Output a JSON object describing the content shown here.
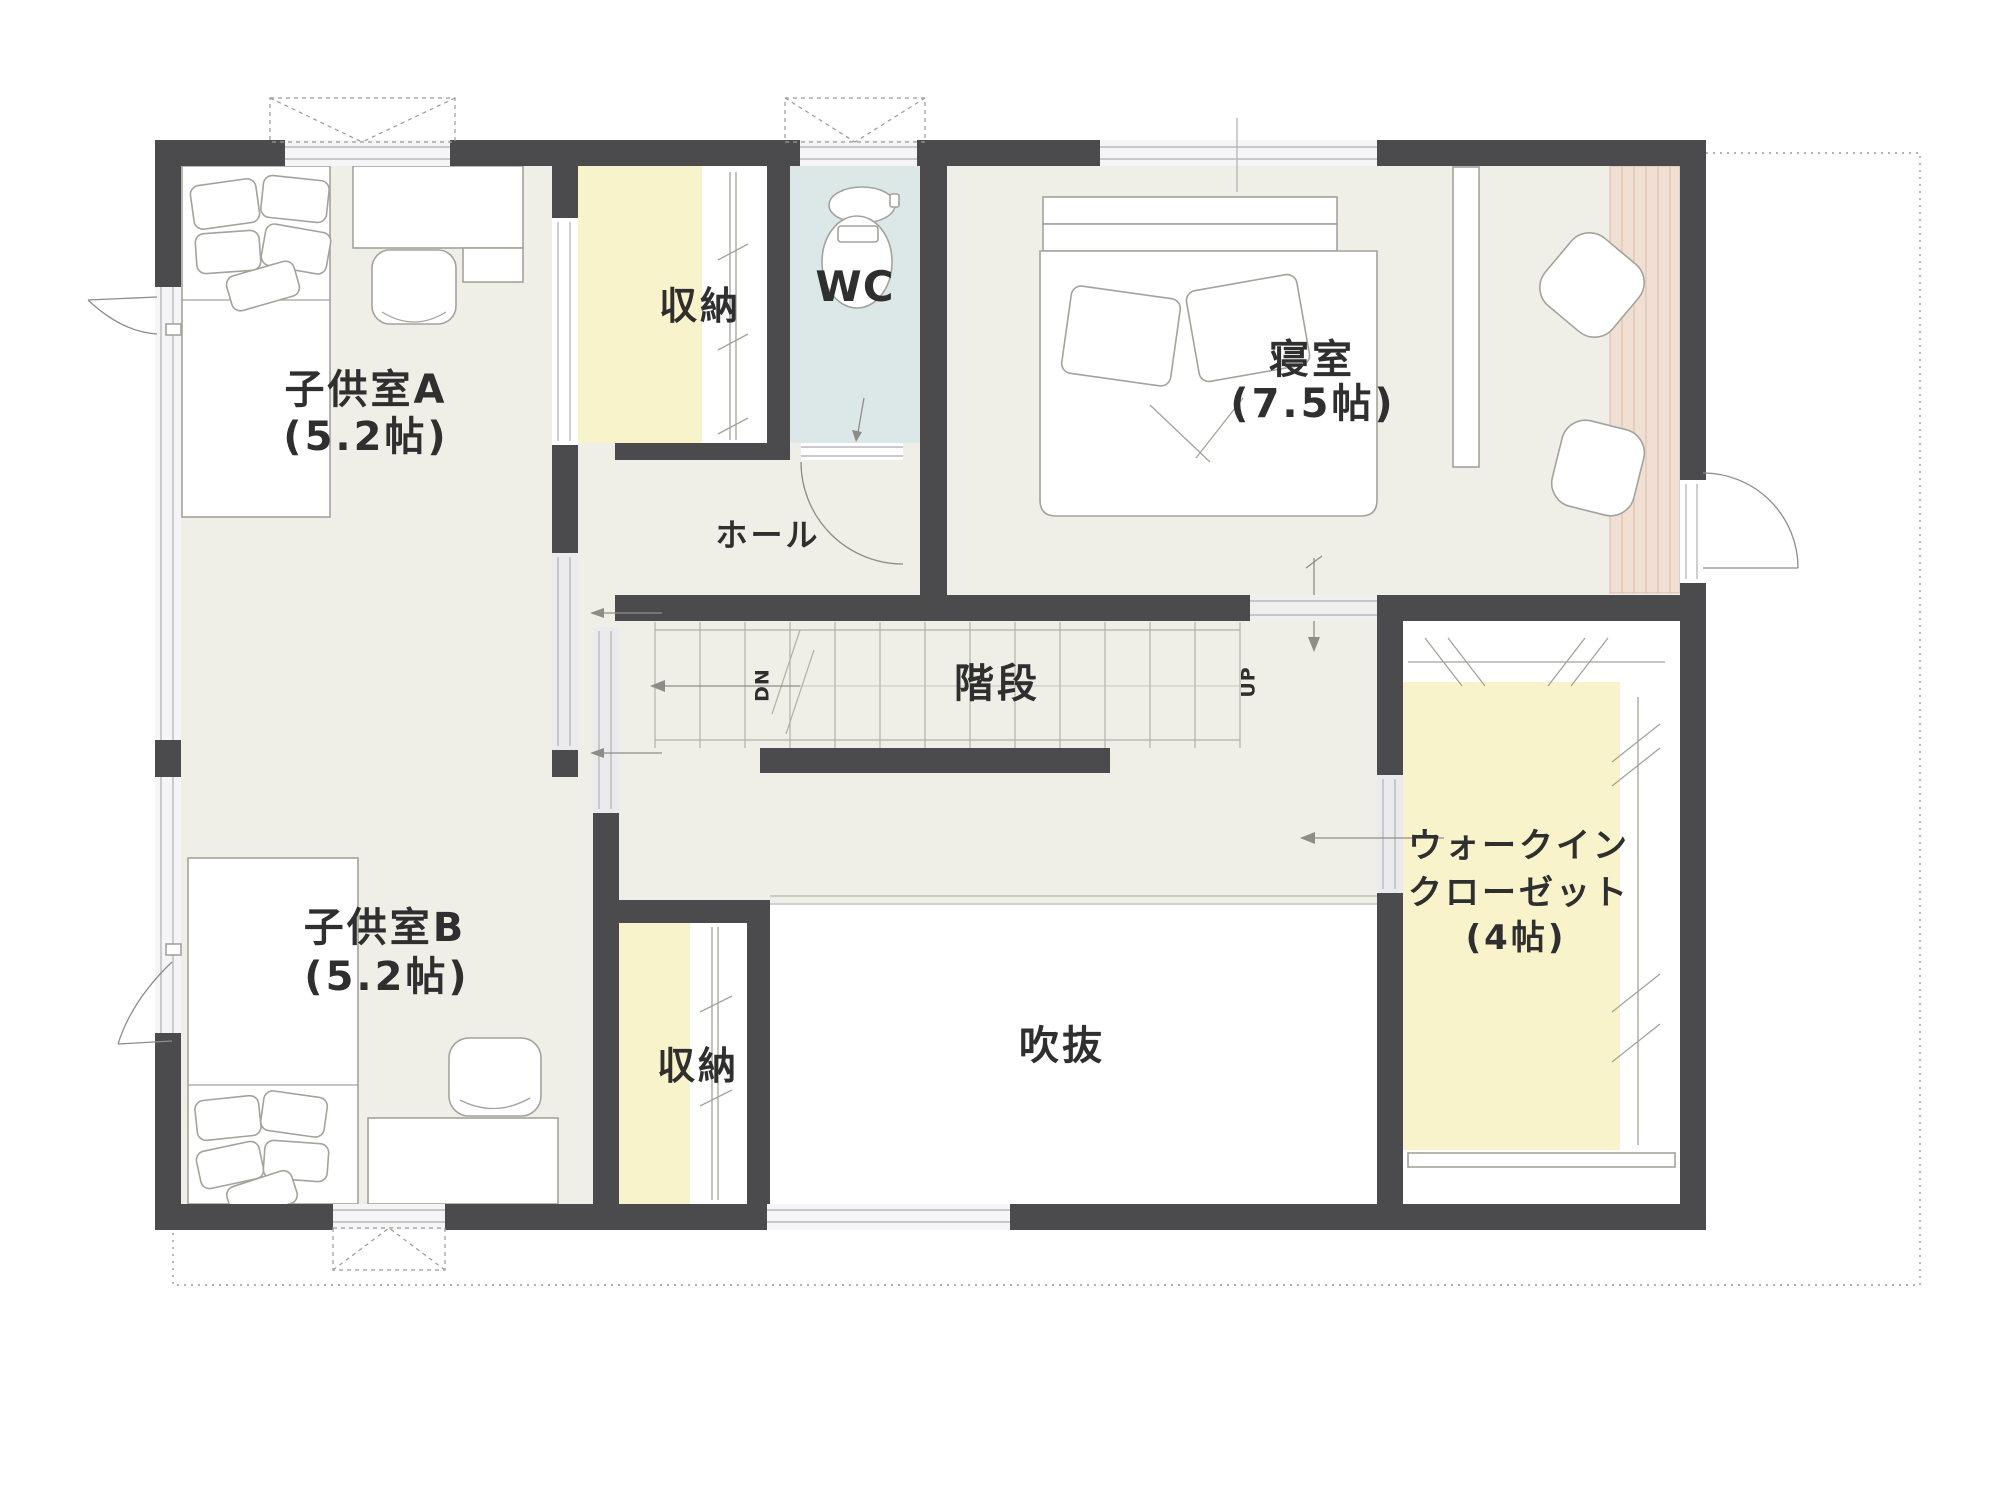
{
  "labels": {
    "kids_a": "子供室A",
    "kids_a_size": "(5.2帖)",
    "kids_b": "子供室B",
    "kids_b_size": "(5.2帖)",
    "bedroom": "寝室",
    "bedroom_size": "(7.5帖)",
    "wic_line1": "ウォークイン",
    "wic_line2": "クローゼット",
    "wic_size": "(4帖)",
    "hall": "ホール",
    "stairs": "階段",
    "void": "吹抜",
    "wc": "WC",
    "storage_top": "収納",
    "storage_bottom": "収納",
    "stairs_down": "DN",
    "stairs_up": "UP"
  },
  "colors": {
    "wall": "#4b4b4d",
    "floor": "#f0efe7",
    "closet_yellow": "#f8f3cb",
    "wc_blue": "#dbe8e7",
    "counter_pink": "#f2dfd3",
    "stripe_pink": "#d9bcab",
    "text": "#2f2f2f"
  }
}
